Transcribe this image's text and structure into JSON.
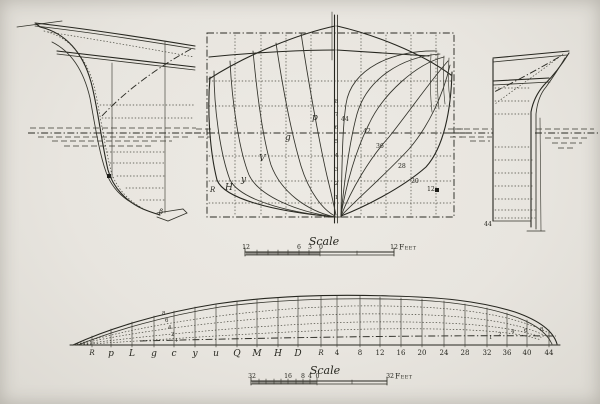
{
  "palette": {
    "paper": "#e9e6e0",
    "ink": "#26261f"
  },
  "bow_profile": {
    "forefoot_label": "β"
  },
  "body_plan": {
    "forward_labels": [
      "R",
      "H",
      "y",
      "V",
      "g",
      "p"
    ],
    "aft_labels": [
      "44",
      "42",
      "36",
      "28",
      "20",
      "12"
    ],
    "centerline_labels": [
      "8",
      "7",
      "6",
      "5",
      "4",
      "3",
      "2",
      "1"
    ]
  },
  "stern_profile": {
    "post_label": "44"
  },
  "half_breadth": {
    "station_labels": [
      "R",
      "p",
      "L",
      "g",
      "c",
      "y",
      "u",
      "Q",
      "M",
      "H",
      "D",
      "R",
      "4",
      "8",
      "12",
      "16",
      "20",
      "24",
      "28",
      "32",
      "36",
      "40",
      "44"
    ],
    "diagonal_labels": [
      "8",
      "6",
      "4",
      "2",
      "+"
    ],
    "aft_waterline_labels": [
      "1",
      "2",
      "4",
      "6",
      "8"
    ]
  },
  "body_scale": {
    "title": "Scale",
    "ticks": [
      "12",
      "6",
      "3",
      "0"
    ],
    "end_value": "12",
    "unit": "Feet"
  },
  "plan_scale": {
    "title": "Scale",
    "ticks": [
      "32",
      "16",
      "8",
      "4",
      "0"
    ],
    "end_value": "32",
    "unit": "Feet"
  }
}
